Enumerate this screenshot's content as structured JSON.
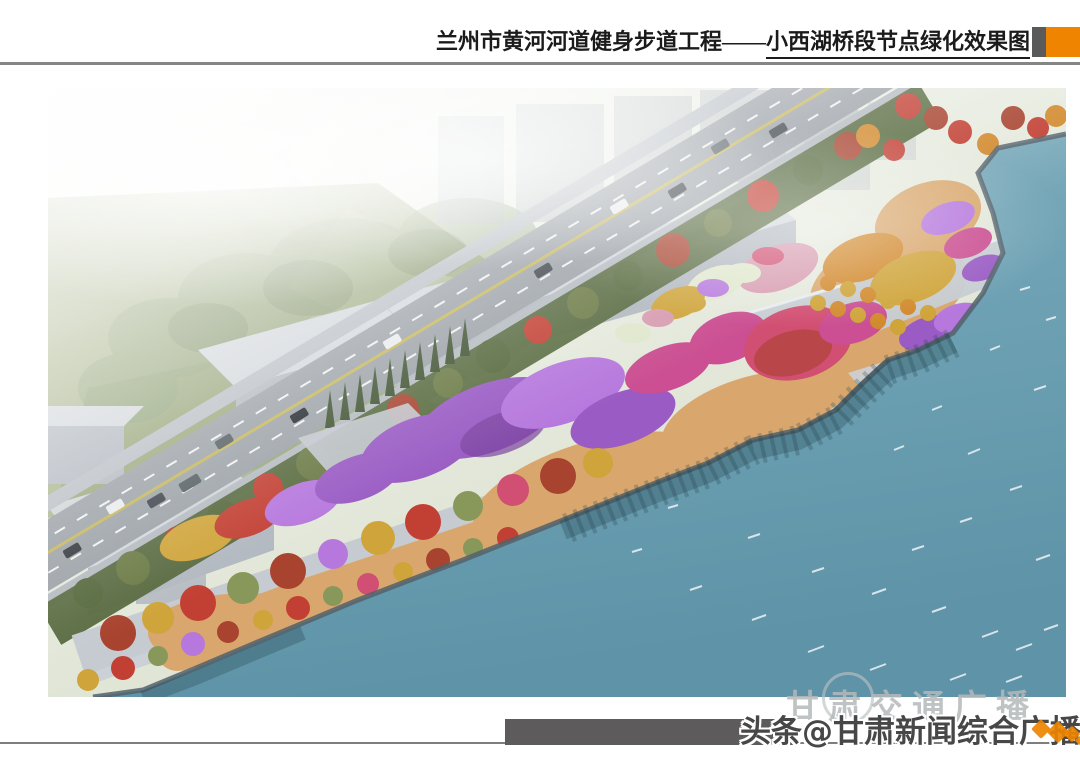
{
  "header": {
    "title_main": "兰州市黄河河道健身步道工程",
    "title_dash": "——",
    "title_sub": "小西湖桥段节点绿化效果图"
  },
  "watermarks": {
    "faint_text": "甘肃交通广播",
    "bold_text": "头条@甘肃新闻综合广播"
  },
  "palette": {
    "accent": "#EE8400",
    "ink": "#1b1b1b",
    "rule": "#858585",
    "block_gray": "#5a5a5a",
    "bar_gray": "#5d5b5b",
    "wm_ink": "#474747",
    "wm_faint": "#b4b9ba",
    "water_1": "#8ab4c2",
    "water_2": "#5f93a7",
    "sand": "#d9a76d",
    "plaza": "#c6ccd2",
    "road": "#9aa0a6",
    "sidewalk": "#b8bec4",
    "field": "#a9b48c",
    "haze_tree": "#8da076",
    "tree_dark": "#55683c",
    "tree_olive": "#6b7a45",
    "conifer": "#3e5130",
    "building_side": "#b2b8c0",
    "building_top": "#d2d6db",
    "shore": "#52626a",
    "fl_purple": "#9a5cc4",
    "fl_violet": "#b678dd",
    "fl_magenta": "#cb4f92",
    "fl_rose": "#d14f72",
    "fl_red": "#c23f33",
    "fl_red2": "#a8432f",
    "fl_orange": "#d28a2e",
    "fl_gold": "#cfa43a",
    "fl_pink": "#d79cb0",
    "fl_white": "#dfe7cc",
    "fl_green": "#87985a",
    "lane_yellow": "#c9b84e"
  }
}
